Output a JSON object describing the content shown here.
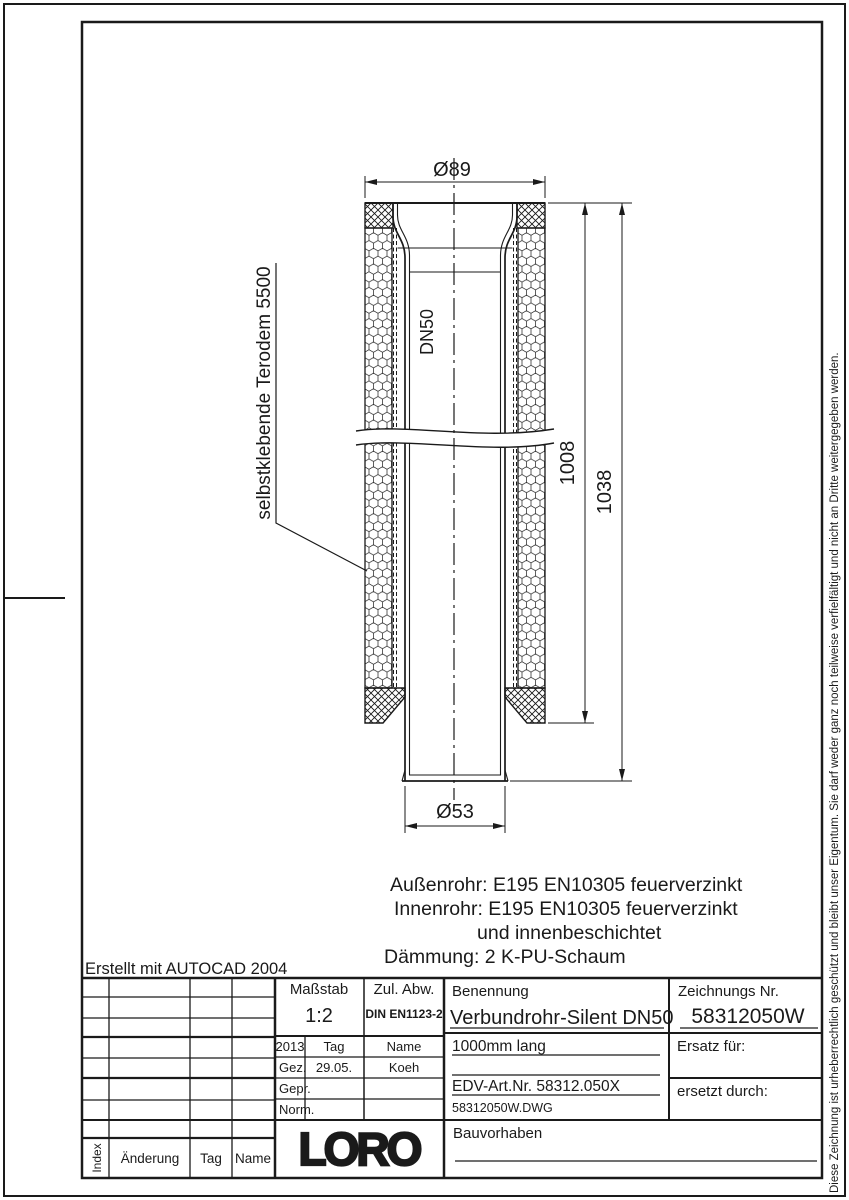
{
  "colors": {
    "ink": "#1a1a1a",
    "paper": "#ffffff"
  },
  "drawing": {
    "dim_top_diameter": "Ø89",
    "dim_bottom_diameter": "Ø53",
    "dim_insulated_length": "1008",
    "dim_total_length": "1038",
    "pipe_size_label": "DN50",
    "leader_label": "selbstklebende Terodem 5500",
    "material_lines": [
      "Außenrohr: E195 EN10305 feuerverzinkt",
      "Innenrohr: E195 EN10305 feuerverzinkt",
      "und innenbeschichtet",
      "Dämmung: 2 K-PU-Schaum"
    ]
  },
  "created_with": "Erstellt mit AUTOCAD 2004",
  "title_block": {
    "scale_label": "Maßstab",
    "scale_value": "1:2",
    "tolerance_label": "Zul. Abw.",
    "tolerance_value": "DIN EN1123-2",
    "name_label": "Benennung",
    "name_value": "Verbundrohr-Silent DN50",
    "drawing_no_label": "Zeichnungs Nr.",
    "drawing_no_value": "58312050W",
    "year": "2013",
    "tag_header": "Tag",
    "name_header": "Name",
    "drawn_label": "Gez.",
    "drawn_date": "29.05.",
    "drawn_by": "Koeh",
    "checked_label": "Gepr.",
    "norm_label": "Norm.",
    "length_note": "1000mm lang",
    "edv_art_no": "EDV-Art.Nr. 58312.050X",
    "dwg_file": "58312050W.DWG",
    "replacement_for_label": "Ersatz für:",
    "replaced_by_label": "ersetzt durch:",
    "project_label": "Bauvorhaben",
    "logo_text": "LORO",
    "index_header": "Index",
    "change_header": "Änderung",
    "tag_col_header": "Tag",
    "name_col_header": "Name"
  },
  "copyright_note": "Diese Zeichnung ist urheberrechtlich geschützt und bleibt unser Eigentum. Sie darf weder ganz noch teilweise verfielfältigt und nicht an Dritte weitergegeben werden."
}
